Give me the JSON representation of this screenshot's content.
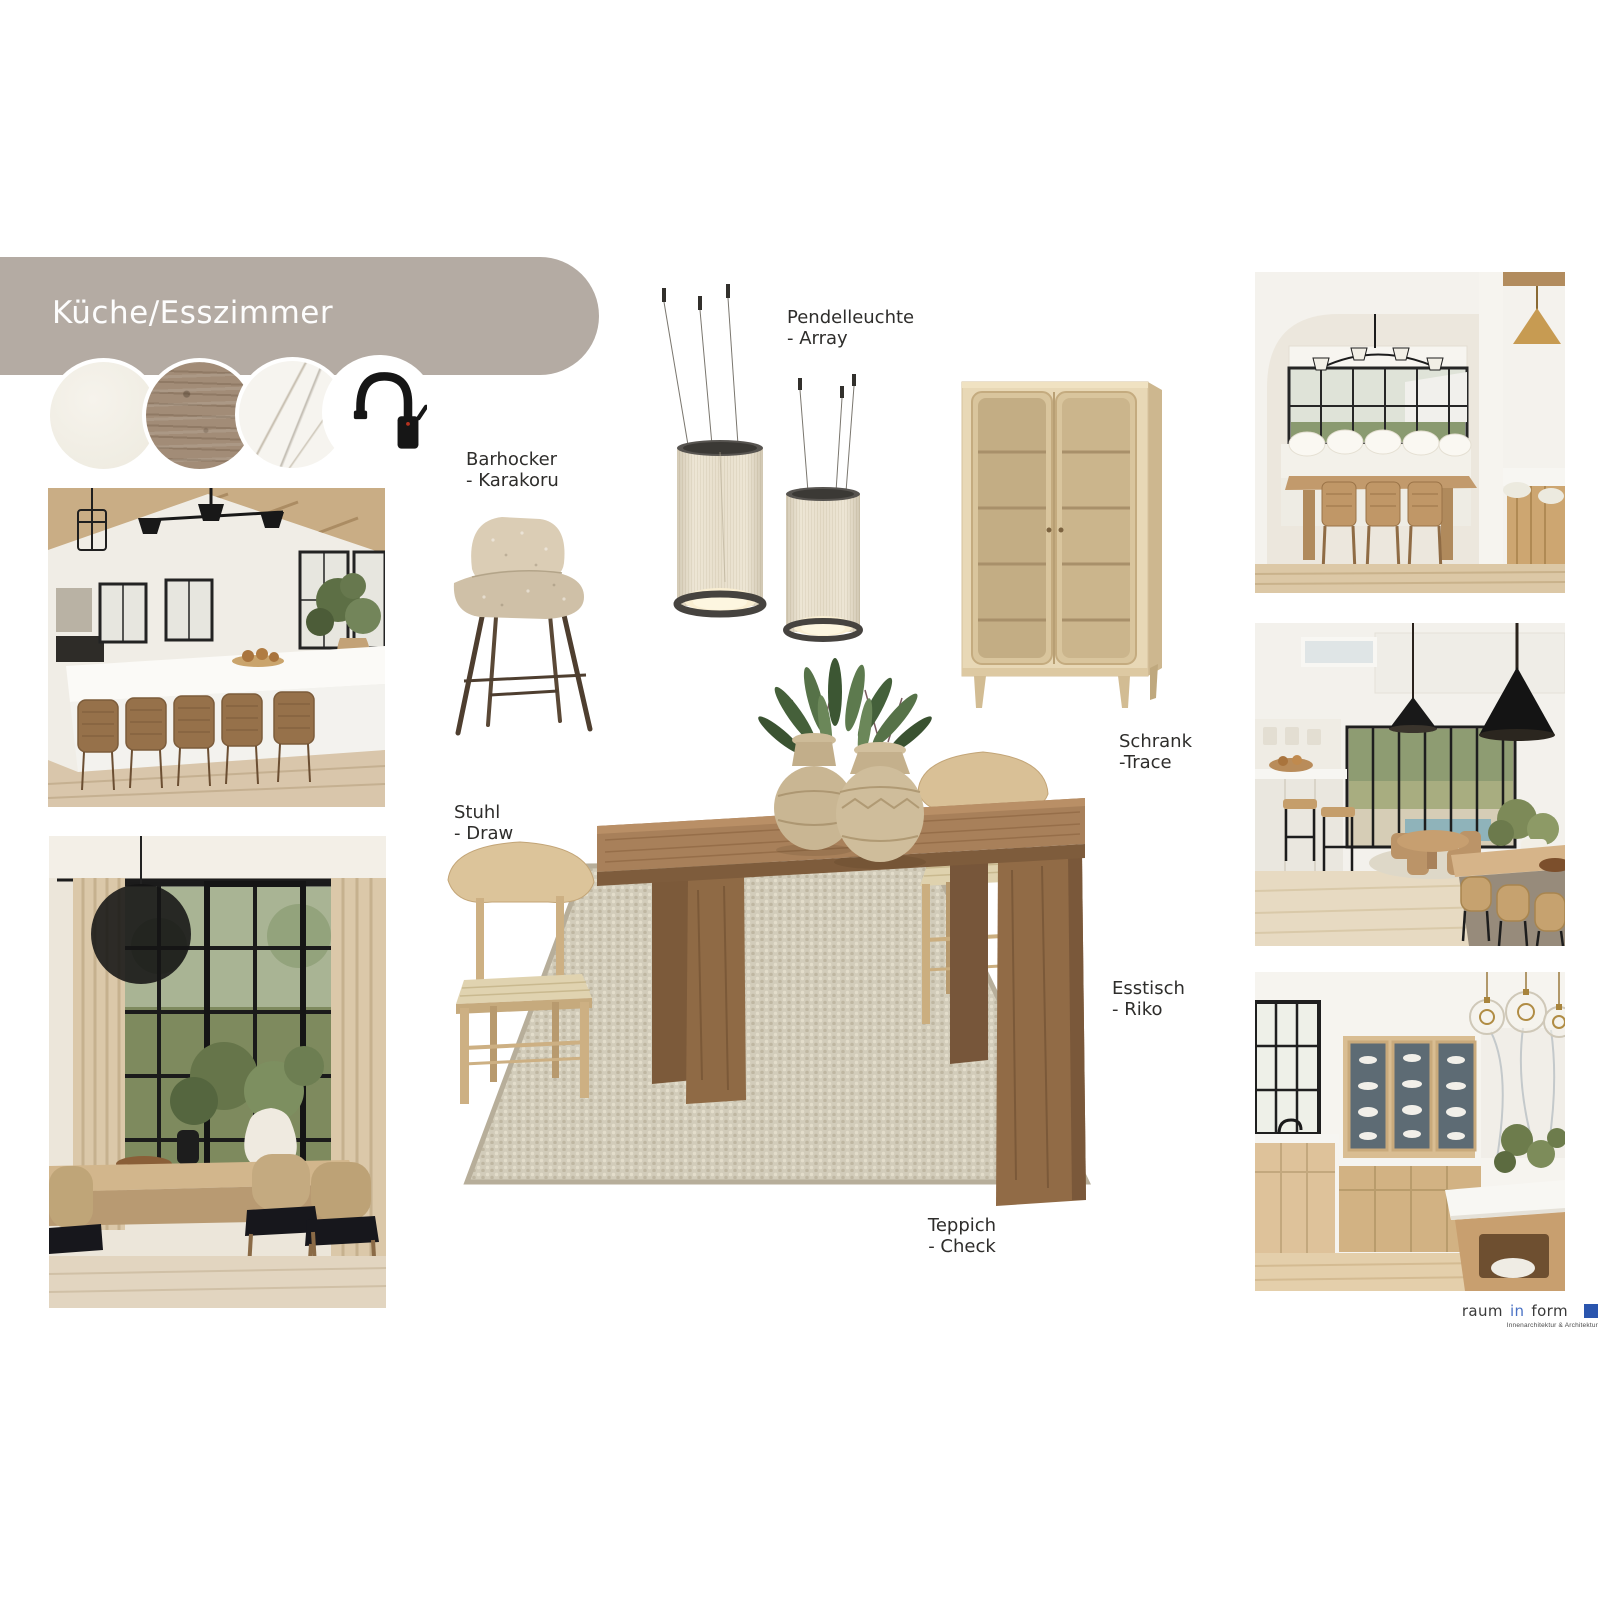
{
  "header": {
    "title": "Küche/Esszimmer"
  },
  "materials": {
    "swatches": [
      {
        "name": "worktop-cream",
        "color": "#f2efe7"
      },
      {
        "name": "wood-floor-oak",
        "color": "#a28c77"
      },
      {
        "name": "marble-white",
        "color": "#f6f4ef"
      },
      {
        "name": "faucet-black",
        "color": "#ffffff"
      }
    ]
  },
  "products": {
    "barhocker": {
      "name": "Barhocker",
      "variant": "- Karakoru"
    },
    "pendelleuchte": {
      "name": "Pendelleuchte",
      "variant": "- Array"
    },
    "schrank": {
      "name": "Schrank",
      "variant": "-Trace"
    },
    "stuhl": {
      "name": "Stuhl",
      "variant": "- Draw"
    },
    "esstisch": {
      "name": "Esstisch",
      "variant": "- Riko"
    },
    "teppich": {
      "name": "Teppich",
      "variant": "- Check"
    }
  },
  "logo": {
    "part1": "raum",
    "part2": "in",
    "part3": "form",
    "subtitle": "Innenarchitektur & Architektur",
    "in_color": "#4a72c4",
    "square_color": "#2a55ae"
  },
  "colors": {
    "banner": "#b4aba3",
    "label_text": "#2e2d2b",
    "canvas": "#ffffff"
  }
}
